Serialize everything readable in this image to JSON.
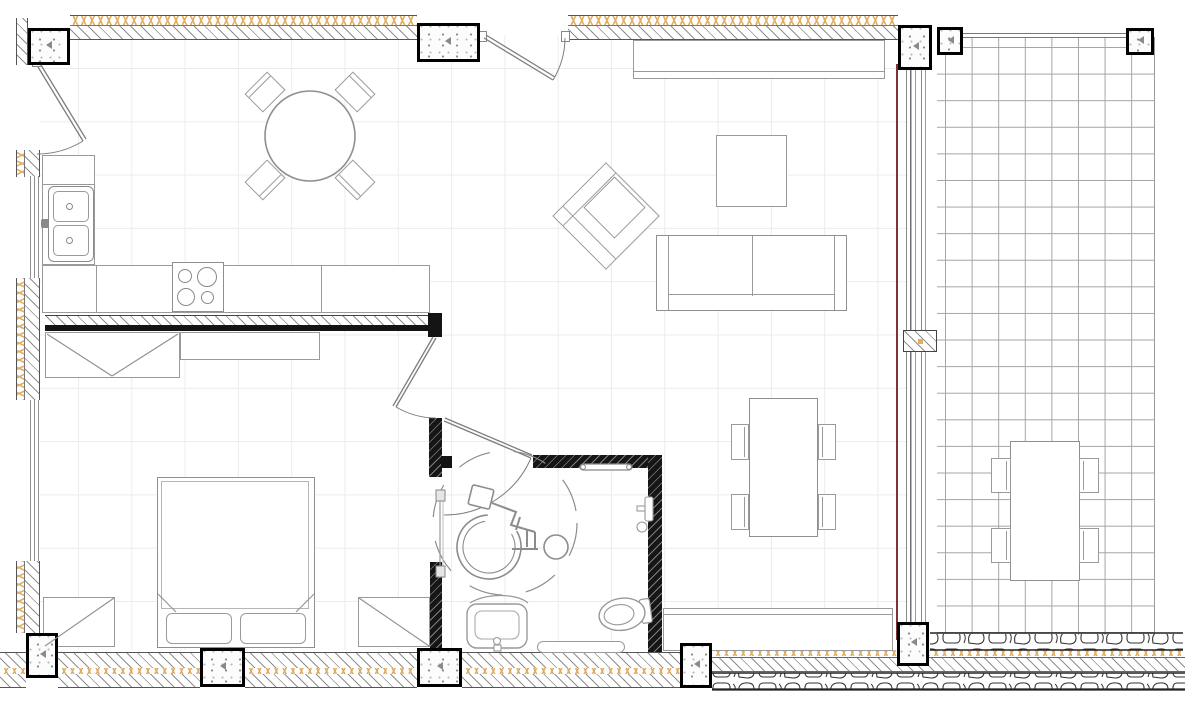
{
  "document": {
    "kind": "architectural-floor-plan",
    "view": "top-down plan of an accessible apartment with balcony",
    "visible_text": "none"
  },
  "colors": {
    "background": "#ffffff",
    "interior_tile_grid": "#ececec",
    "balcony_tile_grid": "#a5a5a5",
    "wall_hatch": "#8f8f8f",
    "insulation": "#e2ae62",
    "structure_black": "#161616",
    "column_border": "#000000",
    "furniture_line": "#9a9a9a",
    "glazing_accent": "#7e3436",
    "stone_masonry": "#333333"
  },
  "grid_module_px": {
    "interior": 53,
    "balcony": 27
  },
  "rooms": [
    {
      "name": "kitchen"
    },
    {
      "name": "dining-area"
    },
    {
      "name": "living-room"
    },
    {
      "name": "hall"
    },
    {
      "name": "bedroom"
    },
    {
      "name": "accessible-bathroom"
    },
    {
      "name": "balcony"
    }
  ],
  "inventory": {
    "structural_columns": 10,
    "doors": 4,
    "window_strips_left_wall": 2,
    "glazed_wall_to_balcony": 1,
    "kitchen": [
      "l-shaped-counter",
      "double-basin-sink",
      "cooktop-4-burner",
      "wardrobe-with-v-symbol",
      "base-cabinet"
    ],
    "dining_area": [
      "round-table",
      "4-diagonal-chairs"
    ],
    "living_room": [
      "tv-sideboard",
      "armchair-rotated-45",
      "coffee-table",
      "two-seat-sofa",
      "dining-table-with-4-chairs",
      "bench-sideboard"
    ],
    "bedroom": [
      "double-bed-with-2-pillows",
      "nightstand-left",
      "nightstand-right"
    ],
    "bathroom": [
      "wheelchair-turning-circle-symbol",
      "washbasin",
      "toilet",
      "grab-bar",
      "shower-screen",
      "shower-fixture",
      "bath-mat"
    ],
    "balcony": [
      "outdoor-table",
      "4-outdoor-chairs"
    ]
  }
}
